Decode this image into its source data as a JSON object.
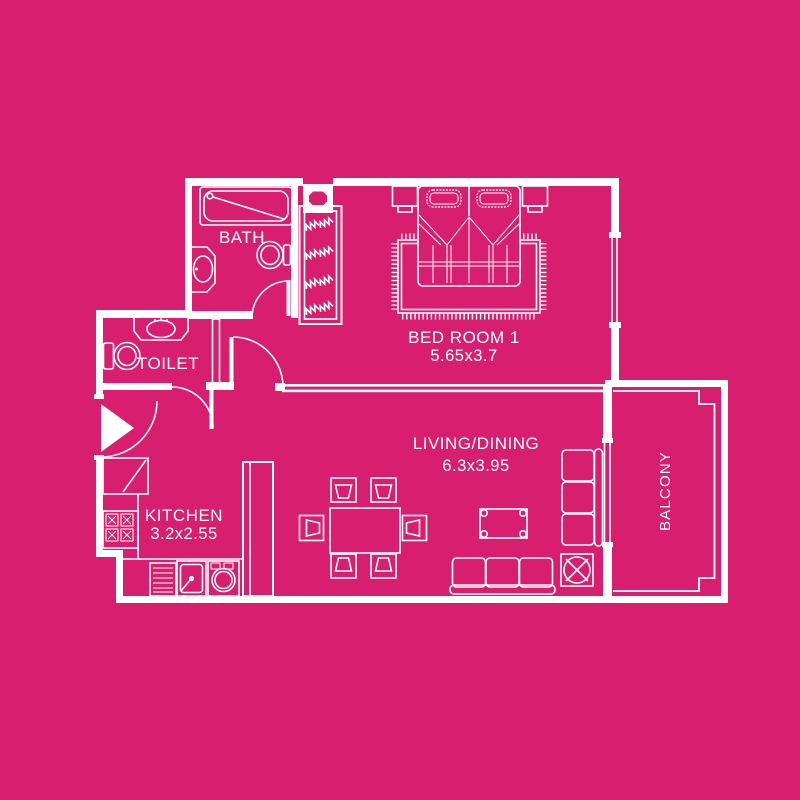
{
  "palette": {
    "background": "#d81e6e",
    "line": "#ffffff"
  },
  "plan_type": "apartment-floor-plan",
  "rooms": {
    "bath": {
      "label": "BATH",
      "fixtures": [
        "bathtub",
        "washbasin",
        "toilet",
        "door"
      ]
    },
    "toilet": {
      "label": "TOILET",
      "fixtures": [
        "washbasin",
        "toilet",
        "door"
      ]
    },
    "kitchen": {
      "label": "KITCHEN",
      "dimensions": "3.2x2.55",
      "fixtures": [
        "corner-cabinet",
        "stove-4-burner",
        "drainboard",
        "sink",
        "washing-machine",
        "tall-cabinet"
      ]
    },
    "bedroom": {
      "label": "BED ROOM 1",
      "dimensions": "5.65x3.7",
      "fixtures": [
        "double-bed",
        "pillows",
        "nightstand",
        "nightstand",
        "rug",
        "wardrobe-hangers",
        "window"
      ]
    },
    "living": {
      "label": "LIVING/DINING",
      "dimensions": "6.3x3.95",
      "fixtures": [
        "dining-table",
        "six-chairs",
        "coffee-table",
        "sofa",
        "corner-sofa",
        "plant"
      ]
    },
    "balcony": {
      "label": "BALCONY",
      "fixtures": [
        "railing"
      ]
    },
    "hall": {
      "fixtures": [
        "entrance-door"
      ]
    }
  }
}
